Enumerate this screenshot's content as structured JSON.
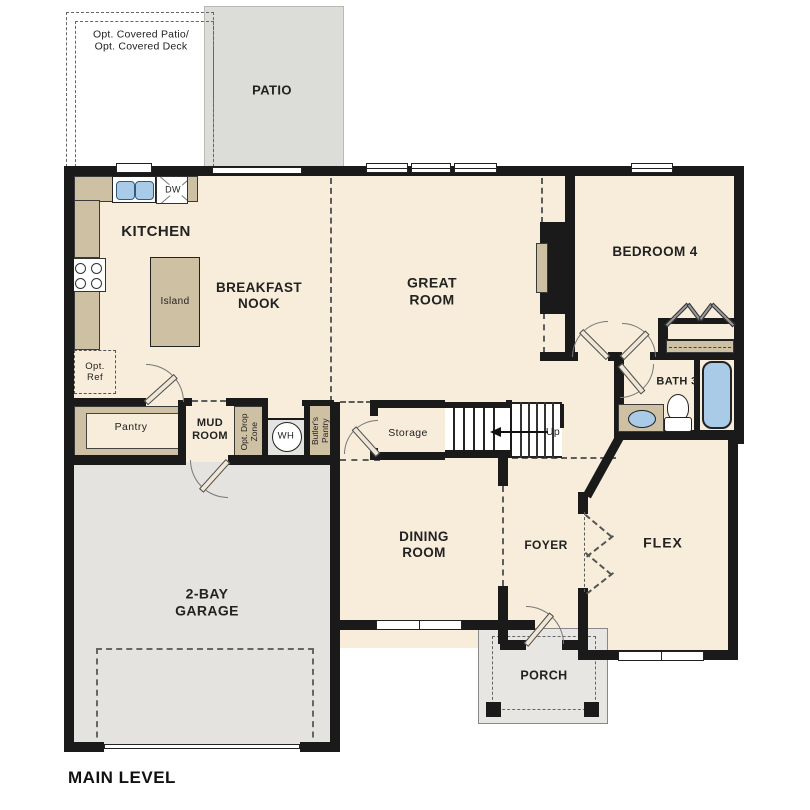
{
  "plan": {
    "title": "MAIN LEVEL",
    "labels": {
      "opt_patio": "Opt. Covered Patio/\nOpt. Covered Deck",
      "patio": "PATIO",
      "kitchen": "KITCHEN",
      "breakfast_nook": "BREAKFAST\nNOOK",
      "great_room": "GREAT\nROOM",
      "bedroom4": "BEDROOM 4",
      "island": "Island",
      "opt_ref": "Opt.\nRef",
      "dw": "DW",
      "pantry": "Pantry",
      "mud_room": "MUD\nROOM",
      "opt_drop_zone": "Opt. Drop\nZone",
      "wh": "WH",
      "butlers_pantry": "Butler's\nPantry",
      "storage": "Storage",
      "up": "Up",
      "bath3": "BATH 3",
      "dining_room": "DINING\nROOM",
      "foyer": "FOYER",
      "flex": "FLEX",
      "garage": "2-BAY\nGARAGE",
      "porch": "PORCH"
    },
    "palette": {
      "floor": "#f7edda",
      "patio": "#dcdcd9",
      "garage": "#e4e3df",
      "porch": "#e7e6e2",
      "cabinet": "#cec0a2",
      "fixture_blue": "#a9cbe8",
      "wall": "#1a1a1a",
      "dash": "#555555",
      "text": "#222222"
    }
  }
}
